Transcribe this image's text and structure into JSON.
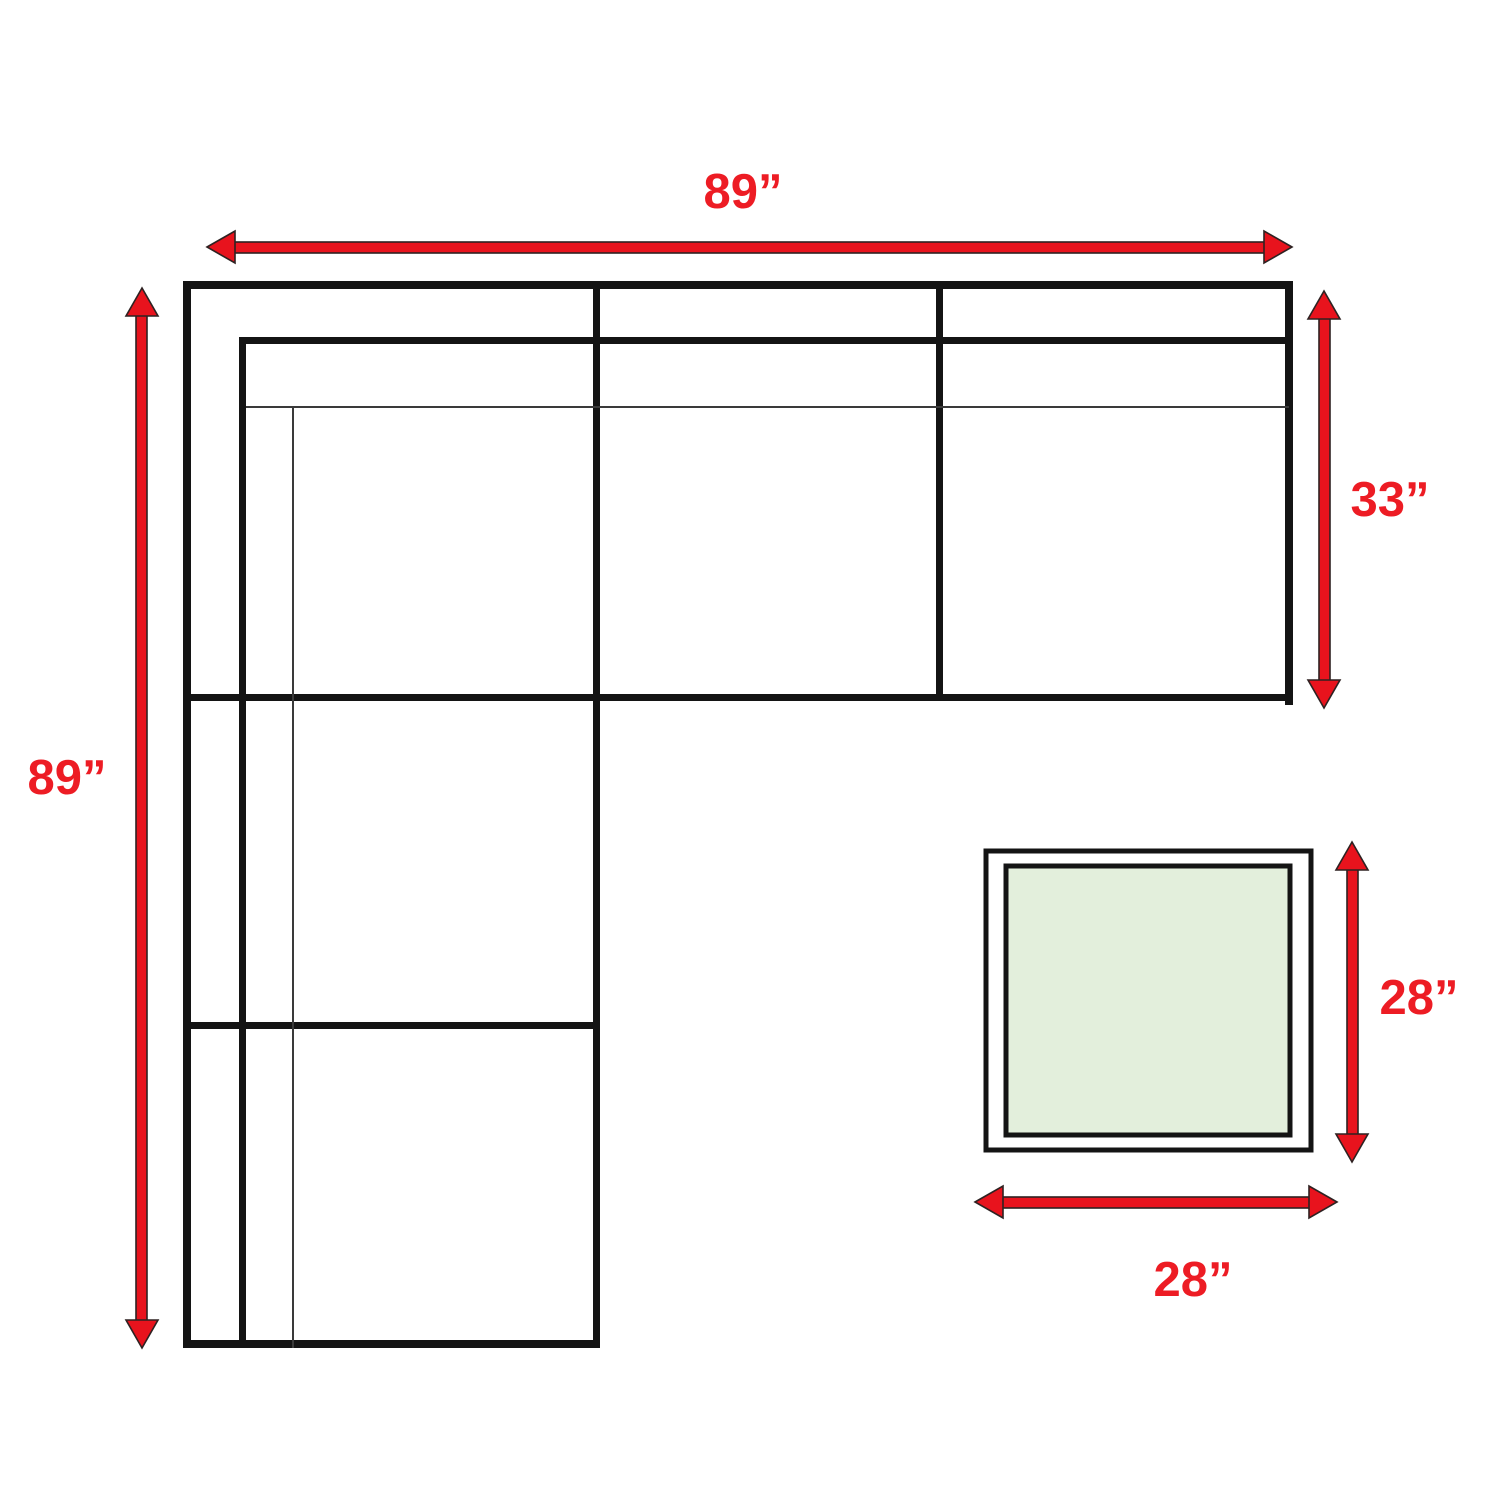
{
  "diagram": {
    "dimensions": {
      "sofa_width_top": "89”",
      "sofa_length_left": "89”",
      "sofa_depth_right": "33”",
      "table_height_right": "28”",
      "table_width_bottom": "28”"
    },
    "colors": {
      "arrow_red": "#e8131d",
      "arrow_outline": "#2e2222",
      "label_red": "#ed1c24",
      "line_black": "#141414",
      "thin_line_gray": "#3a3a3a",
      "table_fill_green": "#e3efdc",
      "background": "#ffffff"
    }
  }
}
